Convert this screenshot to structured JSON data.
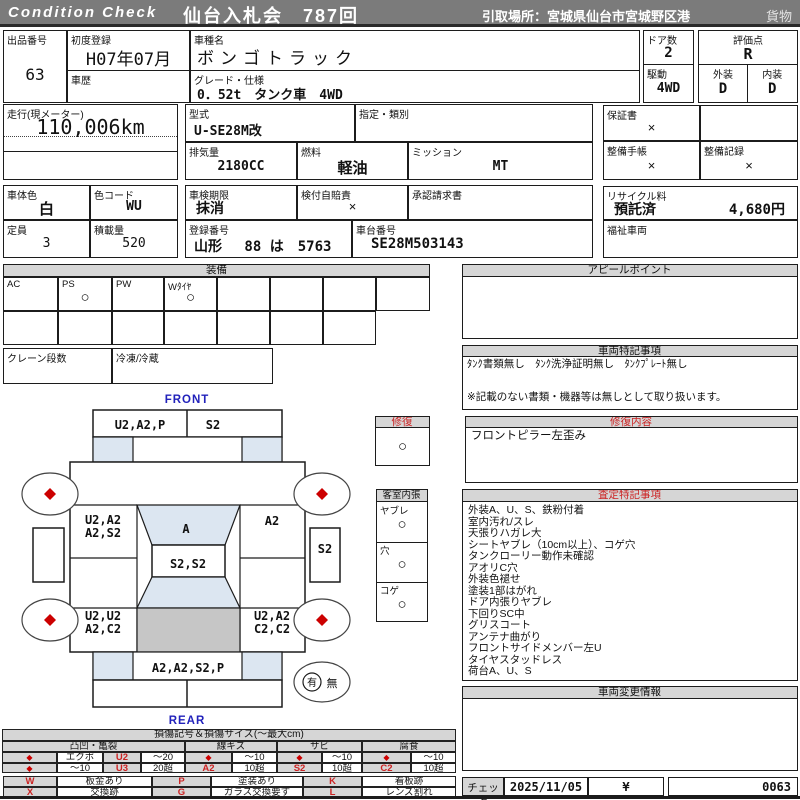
{
  "colors": {
    "accent_red": "#cc2222",
    "accent_blue": "#2222bb",
    "bar_gray": "#7b7b7b",
    "panel_gray": "#d6d6d6",
    "shade_blue": "#dce6f1",
    "bed_gray": "#c6c6c6"
  },
  "header": {
    "brand": "Condition  Check",
    "auction": "仙台入札会　787回",
    "pickup": "引取場所：宮城県仙台市宮城野区港",
    "category": "貨物"
  },
  "info": {
    "lot_label": "出品番号",
    "lot": "63",
    "first_reg_label": "初度登録",
    "first_reg": "H07年07月",
    "history_label": "車歴",
    "history": "",
    "model_name_label": "車種名",
    "model_name": "ボンゴトラック",
    "grade_label": "グレード・仕様",
    "grade": "0．52t　タンク車　4WD",
    "doors_label": "ドア数",
    "doors": "2",
    "score_label": "評価点",
    "score": "R",
    "drive_label": "駆動",
    "drive": "4WD",
    "exterior_label": "外装",
    "exterior": "D",
    "interior_label": "内装",
    "interior": "D",
    "mileage_label": "走行(現メーター)",
    "mileage": "110,006km",
    "model_code_label": "型式",
    "model_code": "U-SE28M改",
    "class_label": "指定・類別",
    "class": "",
    "displacement_label": "排気量",
    "displacement": "2180CC",
    "fuel_label": "燃料",
    "fuel": "軽油",
    "transmission_label": "ミッション",
    "transmission": "MT",
    "warranty_label": "保証書",
    "warranty": "×",
    "maintenance_book_label": "整備手帳",
    "maintenance_book": "×",
    "maintenance_record_label": "整備記録",
    "maintenance_record": "×",
    "body_color_label": "車体色",
    "body_color": "白",
    "color_code_label": "色コード",
    "color_code": "WU",
    "inspection_label": "車検期限",
    "inspection": "抹消",
    "insurance_label": "検付自賠責",
    "insurance": "×",
    "approval_label": "承認請求書",
    "approval": "",
    "capacity_label": "定員",
    "capacity": "3",
    "load_label": "積載量",
    "load": "520",
    "reg_number_label": "登録番号",
    "reg_number": "山形　 88 は　5763",
    "chassis_label": "車台番号",
    "chassis": "SE28M503143",
    "recycle_label": "リサイクル料",
    "recycle_status": "預託済",
    "recycle_fee": "4,680円",
    "welfare_label": "福祉車両",
    "welfare": ""
  },
  "equipment": {
    "title": "装備",
    "items": [
      {
        "label": "AC",
        "mark": ""
      },
      {
        "label": "PS",
        "mark": "○"
      },
      {
        "label": "PW",
        "mark": ""
      },
      {
        "label": "Wﾀｲﾔ",
        "mark": "○"
      },
      {
        "label": "",
        "mark": ""
      },
      {
        "label": "",
        "mark": ""
      },
      {
        "label": "",
        "mark": ""
      },
      {
        "label": "",
        "mark": ""
      }
    ],
    "crane_label": "クレーン段数",
    "crane": "",
    "freezer_label": "冷凍/冷蔵",
    "freezer": ""
  },
  "appeal": {
    "title": "アピールポイント",
    "content": ""
  },
  "special": {
    "title": "車両特記事項",
    "line1": "ﾀﾝｸ書類無し　ﾀﾝｸ洗浄証明無し　ﾀﾝｸﾌﾟﾚｰﾄ無し",
    "line2": "※記載のない書類・機器等は無しとして取り扱います。"
  },
  "repair": {
    "label": "修復",
    "mark": "○",
    "detail_title": "修復内容",
    "detail": "フロントピラー左歪み"
  },
  "cabin": {
    "title": "客室内張",
    "items": [
      {
        "label": "ヤブレ",
        "mark": "○"
      },
      {
        "label": "穴",
        "mark": "○"
      },
      {
        "label": "コゲ",
        "mark": "○"
      }
    ]
  },
  "notes": {
    "title": "査定特記事項",
    "items": [
      "外装A、U、S、鉄粉付着",
      "室内汚れ/スレ",
      "天張りハガレ大",
      "シートヤブレ（10cm以上）、コゲ穴",
      "タンクローリー動作未確認",
      "アオリC穴",
      "外装色褪せ",
      "塗装1部はがれ",
      "ドア内張りヤブレ",
      "下回りSC中",
      "グリスコート",
      "アンテナ曲がり",
      "フロントサイドメンバー左U",
      "タイヤスタッドレス",
      "荷台A、U、S"
    ]
  },
  "change": {
    "title": "車両変更情報",
    "content": ""
  },
  "check": {
    "label": "チェック",
    "date": "2025/11/05",
    "inspector": "¥",
    "number": "0063"
  },
  "diagram": {
    "front_label": "FRONT",
    "rear_label": "REAR",
    "front_bumper_left": "U2,A2,P",
    "front_bumper_right": "S2",
    "left_front_1": "U2,A2",
    "left_front_2": "A2,S2",
    "roof": "A",
    "windshield": "S2,S2",
    "right_front": "A2",
    "right_side": "S2",
    "left_rear_1": "U2,U2",
    "left_rear_2": "A2,C2",
    "right_rear_1": "U2,A2",
    "right_rear_2": "C2,C2",
    "rear_gate": "A2,A2,S2,P",
    "spare_yes": "有",
    "spare_no": "無"
  },
  "legend": {
    "title": "損傷記号＆損傷サイズ(〜最大cm)",
    "groups": [
      "凸凹・亀裂",
      "線キズ",
      "サビ",
      "腐食"
    ],
    "rows": [
      [
        "◆",
        "エクボ",
        "U2",
        "〜20",
        "◆",
        "〜10",
        "◆",
        "〜10",
        "◆",
        "〜10"
      ],
      [
        "◆",
        "〜10",
        "U3",
        "20超",
        "A2",
        "10超",
        "S2",
        "10超",
        "C2",
        "10超"
      ]
    ],
    "marks": [
      [
        "W",
        "板金あり",
        "P",
        "塗装あり",
        "K",
        "看板跡"
      ],
      [
        "X",
        "交換跡",
        "G",
        "ガラス交換要す",
        "L",
        "レンズ割れ"
      ]
    ]
  }
}
